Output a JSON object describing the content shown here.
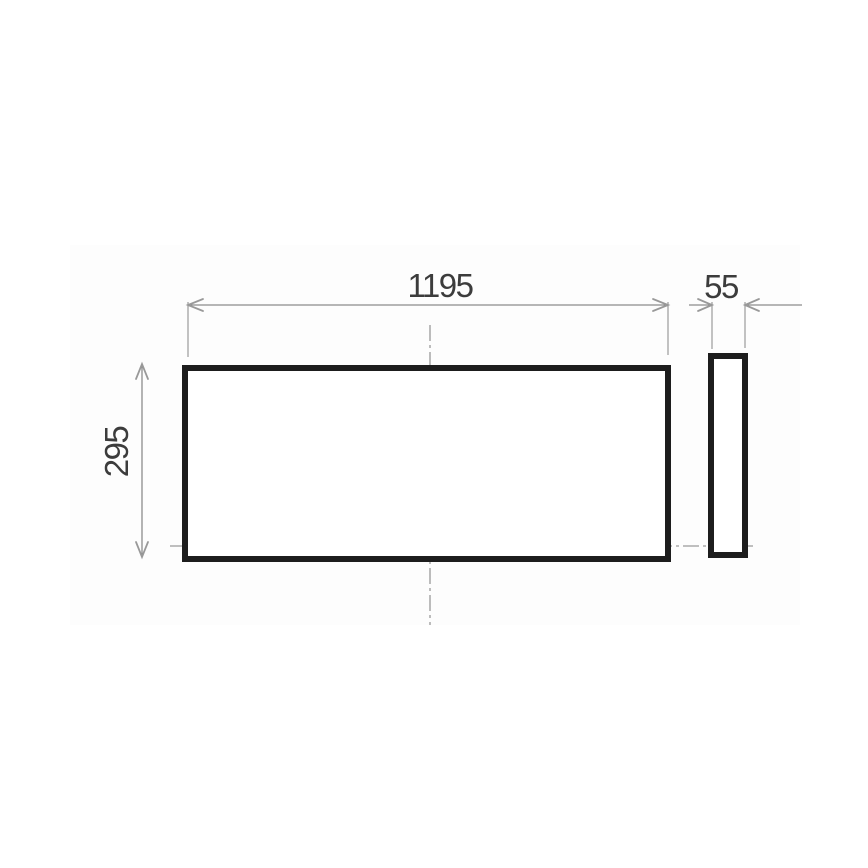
{
  "drawing": {
    "type": "technical-dimension-drawing",
    "views": {
      "front_view": {
        "description": "rectangular panel front view",
        "width_dimension": {
          "value": "1195"
        },
        "height_dimension": {
          "value": "295"
        }
      },
      "side_view": {
        "description": "panel side profile",
        "depth_dimension": {
          "value": "55"
        }
      }
    },
    "icons": {
      "arrowhead_style": "open-chevron-arrowhead"
    },
    "colors": {
      "background": "#ffffff",
      "outline": "#1d1d1d",
      "dimension_line": "#8c8c8c",
      "extension_line": "#9a9a9a",
      "centerline": "#9a9a9a",
      "arrowhead": "#999999",
      "dimension_text": "#3c3c3c"
    }
  }
}
